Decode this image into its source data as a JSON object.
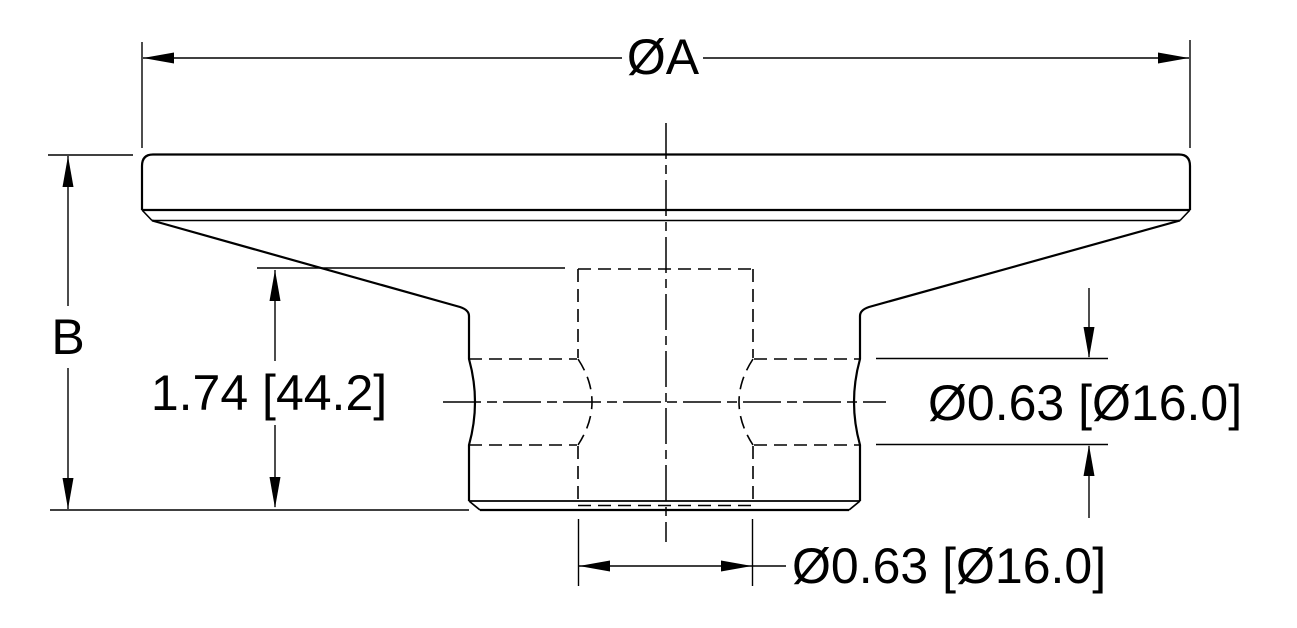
{
  "drawing": {
    "type": "engineering-cross-section",
    "colors": {
      "line": "#000000",
      "background": "#ffffff"
    },
    "labels": {
      "overall_diameter": "ØA",
      "overall_height": "B",
      "boss_height": "1.74 [44.2]",
      "cross_hole_diameter": "Ø0.63 [Ø16.0]",
      "center_hole_diameter": "Ø0.63 [Ø16.0]"
    }
  }
}
